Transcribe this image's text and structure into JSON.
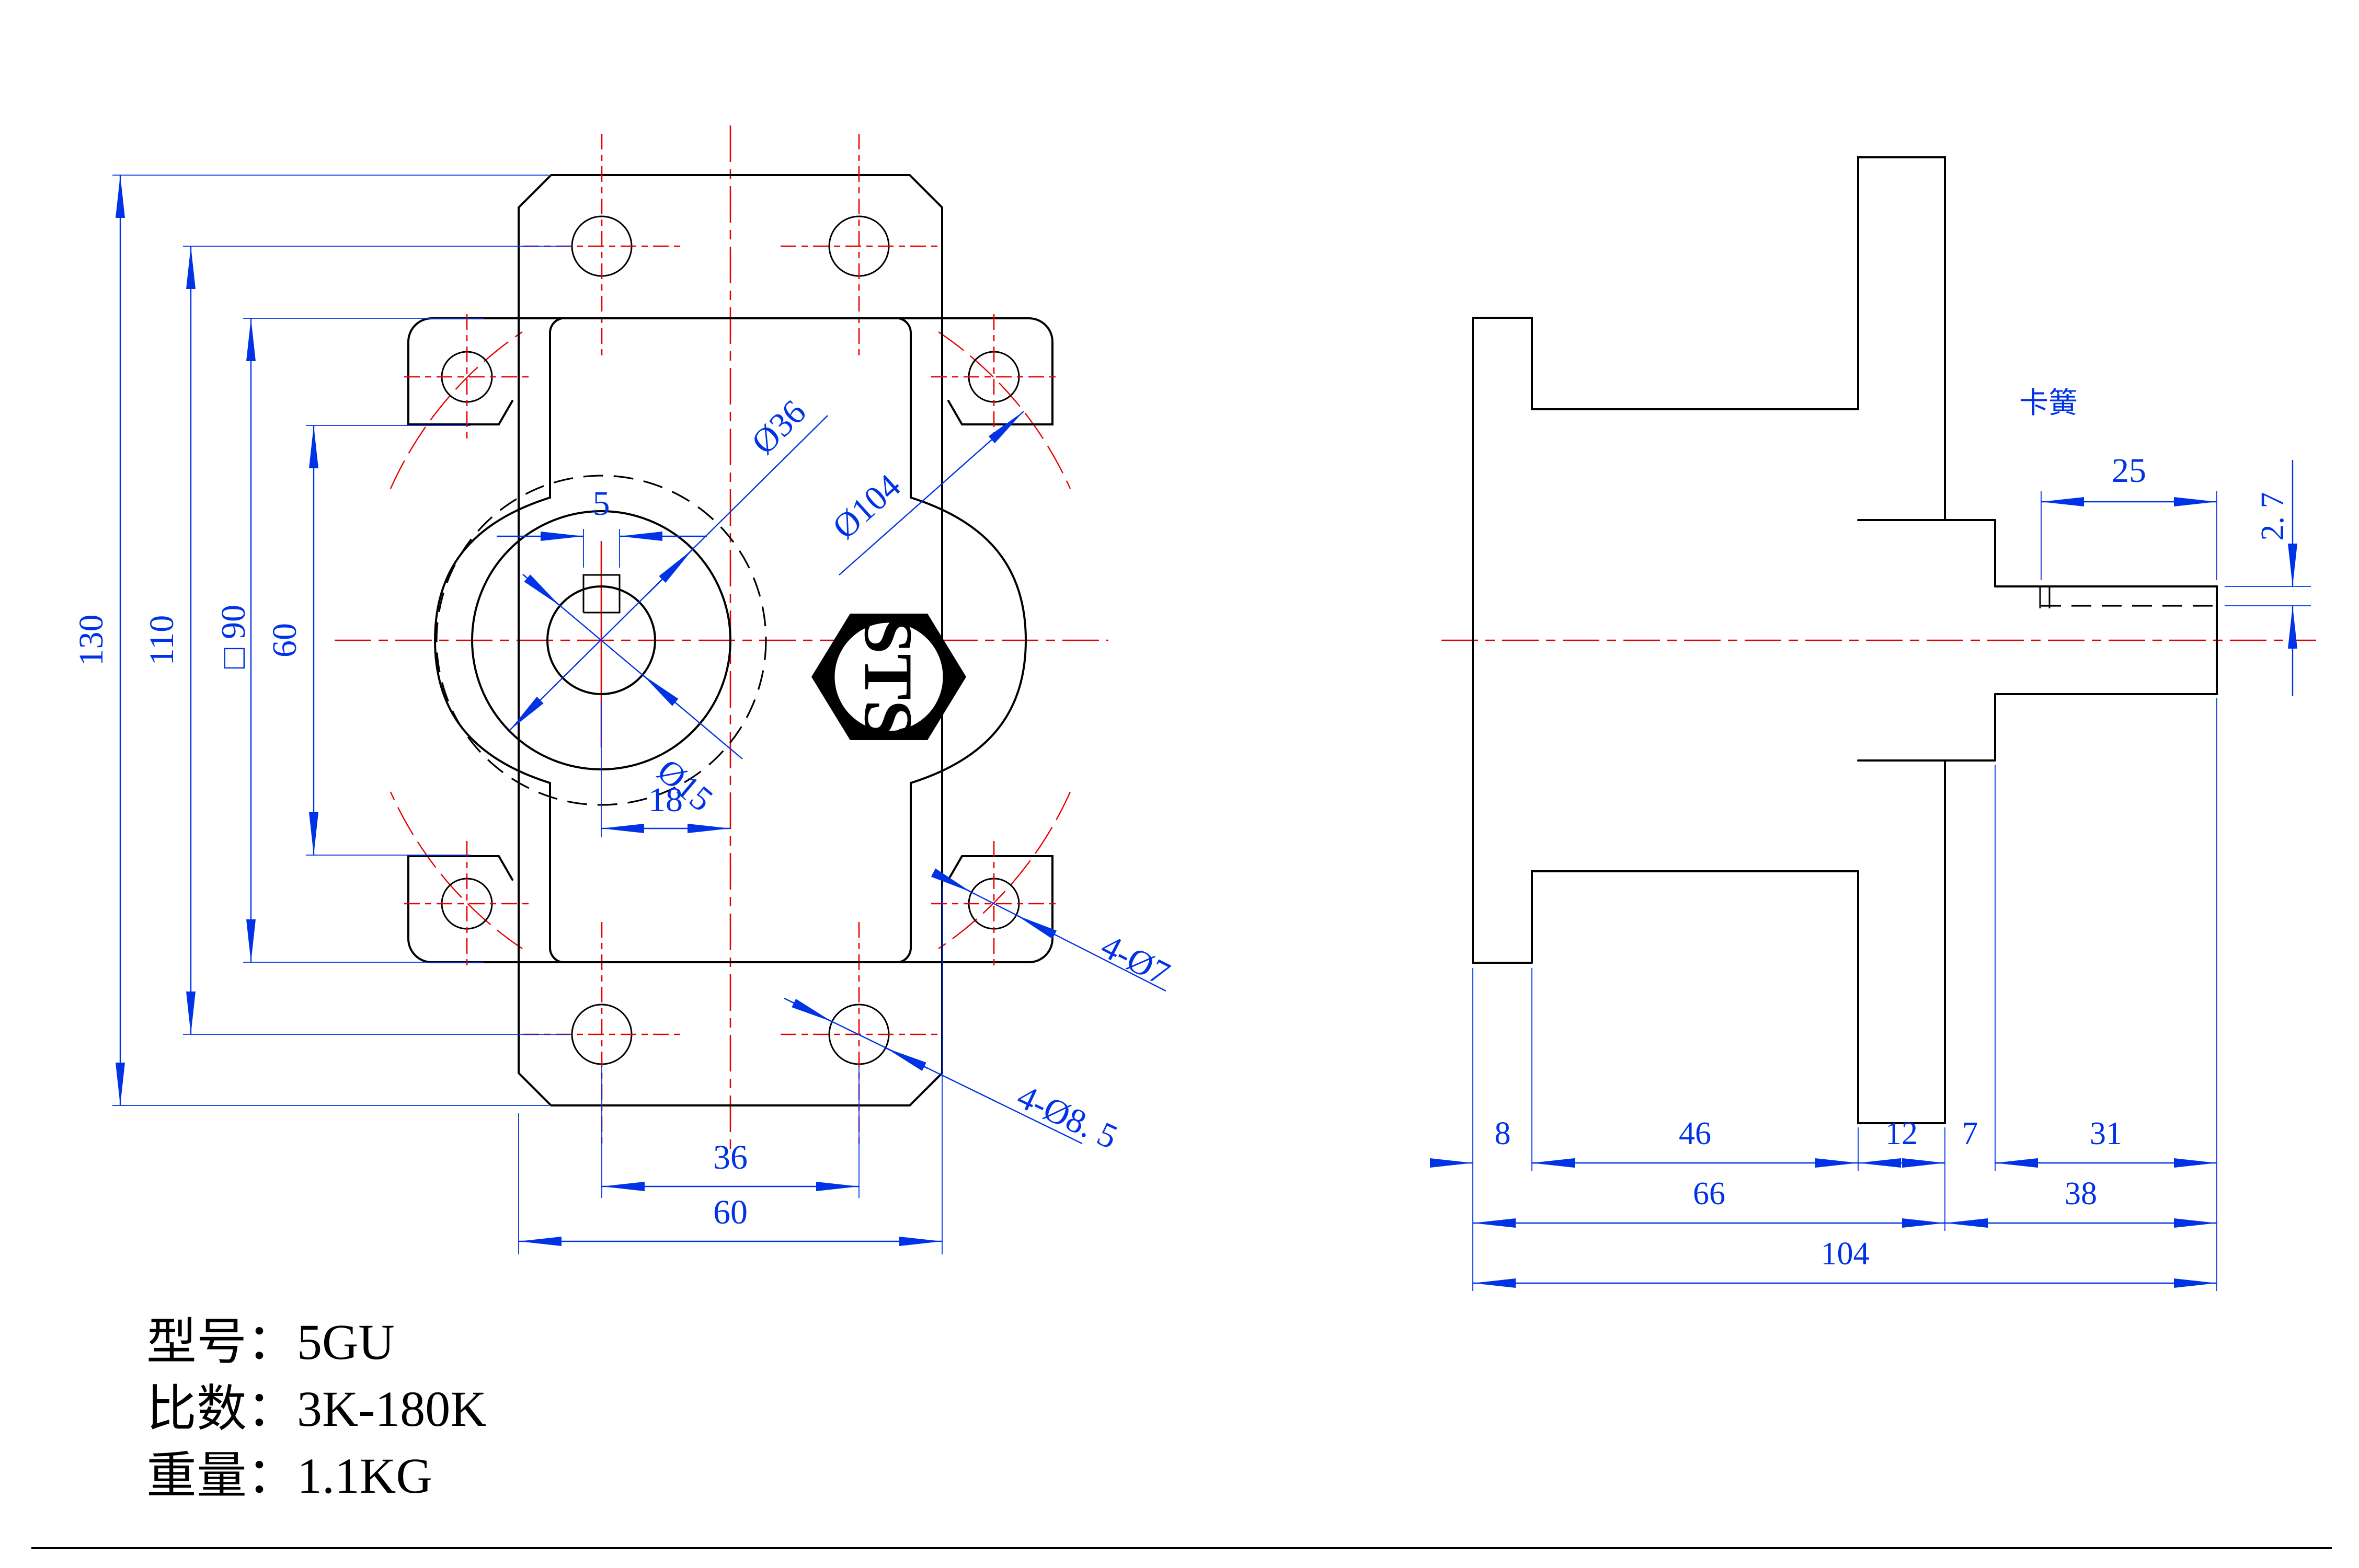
{
  "drawing_type": "engineering-drawing",
  "colors": {
    "dimension": "#0033e6",
    "centerline": "#e60000",
    "outline": "#000000",
    "background": "#ffffff"
  },
  "front_view": {
    "vertical_dims": {
      "overall": "130",
      "hole_span": "110",
      "body": "□ 90",
      "waist": "60"
    },
    "center_dims": {
      "keyway_width": "5",
      "shaft_offset": "18"
    },
    "diameters": {
      "boss": "Ø36",
      "bolt_circle": "Ø104",
      "shaft": "Ø15"
    },
    "hole_callouts": {
      "corner": "4-Ø7",
      "plate": "4-Ø8. 5"
    },
    "bottom_dims": {
      "hole_span": "36",
      "plate_width": "60"
    }
  },
  "side_view": {
    "label_circlip": "卡簧",
    "top_dims": {
      "shaft_usable": "25",
      "groove": "2. 7"
    },
    "row1": {
      "d8": "8",
      "d46": "46",
      "d12": "12",
      "d7": "7",
      "d31": "31"
    },
    "row2": {
      "d66": "66",
      "d38": "38"
    },
    "row3": {
      "d104": "104"
    }
  },
  "logo": {
    "text": "STS"
  },
  "notes": [
    {
      "text": "型号：5GU"
    },
    {
      "text": "比数：3K-180K"
    },
    {
      "text": "重量：1.1KG"
    }
  ]
}
